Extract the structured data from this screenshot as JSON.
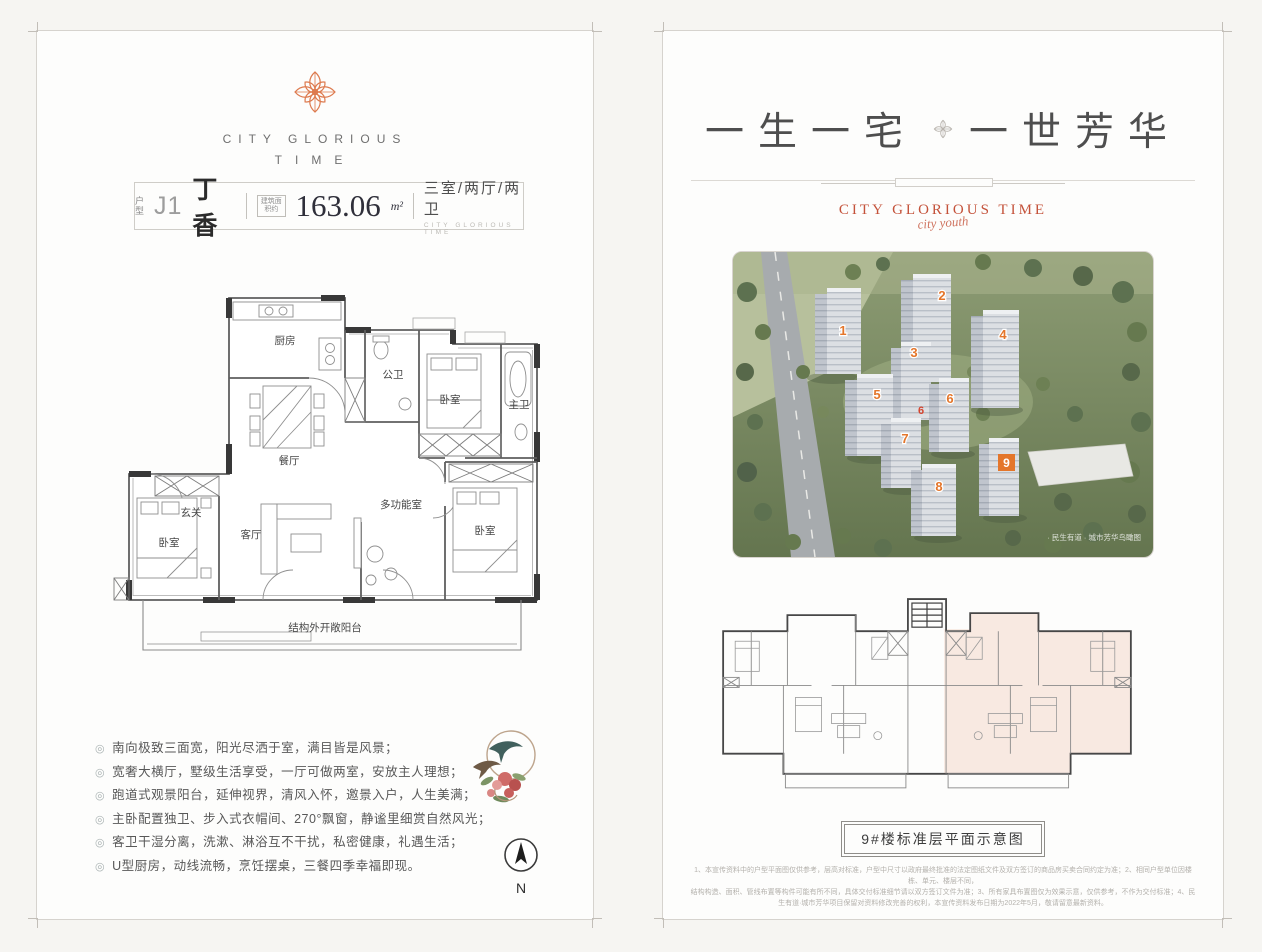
{
  "page": {
    "background": "#f6f5f2",
    "accent_orange": "#dd7a4e",
    "brand_red": "#c4523a"
  },
  "left_panel": {
    "logo": {
      "brand_line1": "CITY GLORIOUS",
      "brand_line2": "TIME"
    },
    "title_bar": {
      "type_label": "户型",
      "unit_code": "J1",
      "unit_name": "丁香",
      "area_label": "建筑面积约",
      "area_value": "163.06",
      "area_unit": "m²",
      "layout_text": "三室/两厅/两卫",
      "layout_subtext": "CITY GLORIOUS TIME"
    },
    "floorplan_rooms": {
      "kitchen": "厨房",
      "dining": "餐厅",
      "entry": "玄关",
      "guest_bath": "公卫",
      "bedroom_top": "卧室",
      "master_bath": "主卫",
      "living": "客厅",
      "multi_room": "多功能室",
      "bedroom_left": "卧室",
      "bedroom_right": "卧室",
      "balcony": "结构外开敞阳台"
    },
    "features": [
      "南向极致三面宽，阳光尽洒于室，满目皆是风景；",
      "宽奢大横厅，墅级生活享受，一厅可做两室，安放主人理想；",
      "跑道式观景阳台，延伸视界，清风入怀，邀景入户，人生美满；",
      "主卧配置独卫、步入式衣帽间、270°飘窗，静谧里细赏自然风光；",
      "客卫干湿分离，洗漱、淋浴互不干扰，私密健康，礼遇生活；",
      "U型厨房，动线流畅，烹饪摆桌，三餐四季幸福即现。"
    ],
    "compass_label": "N"
  },
  "right_panel": {
    "headline": {
      "left": "一生一宅",
      "right": "一世芳华"
    },
    "brand": {
      "text": "CITY GLORIOUS TIME",
      "script": "city youth"
    },
    "aerial": {
      "building_numbers": [
        "1",
        "2",
        "3",
        "4",
        "5",
        "6",
        "7",
        "8",
        "9"
      ],
      "red_mark": "6",
      "watermark": "· 民生有道 · 城市芳华鸟瞰图"
    },
    "floorplate_caption": "9#楼标准层平面示意图",
    "disclaimer": [
      "1、本宣传资料中的户型平面图仅供参考，层高对标准，户型中尺寸以政府最终批准的法定图纸文件及双方签订的商品房买卖合同约定为准；2、相同户型单位因楼栋、单元、楼层不同，",
      "结构构造、面积、管线布置等构件可能有所不同，具体交付标准细节请以双方签订文件为准；3、所有家具布置图仅为效果示意，仅供参考，不作为交付标准；4、民生有道·城市芳华项目保留对资料修改完善的权利，本宣传资料发布日期为2022年5月，敬请留意最新资料。"
    ]
  }
}
